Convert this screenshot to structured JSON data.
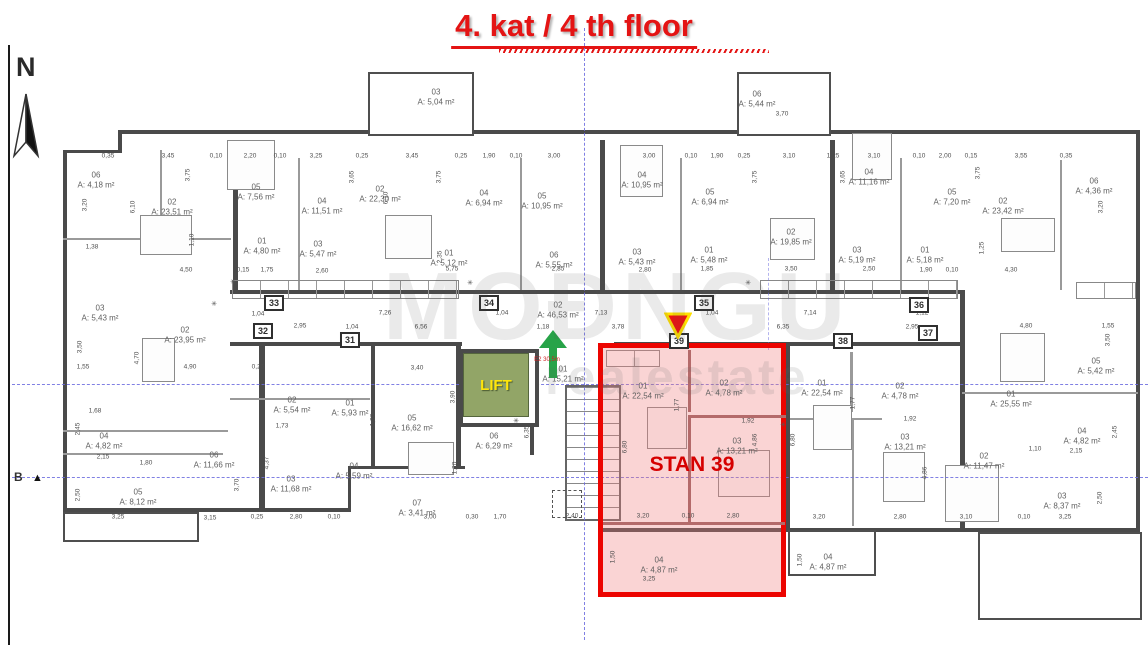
{
  "title": "4. kat / 4 th floor",
  "north": {
    "label": "N"
  },
  "section_marker": {
    "label": "B"
  },
  "watermark": {
    "line1": "MOĐNGU",
    "line2": "realestate"
  },
  "lift": {
    "label": "LIFT"
  },
  "stairwell_note": {
    "text": "E2 30,5m"
  },
  "highlight": {
    "label": "STAN 39",
    "apartment_no": "39"
  },
  "colors": {
    "title_red": "#e41414",
    "highlight_border": "#ec0400",
    "highlight_fill": "rgba(240,125,125,0.33)",
    "lift_green": "#92a567",
    "lift_text": "#ffe60a",
    "axis_blue": "#6b6bdf",
    "arrow_green": "#27a348",
    "marker_yellow": "#ffe000",
    "wall_gray": "#4a4a4a",
    "label_gray": "#5f5f5f"
  },
  "plan": {
    "rooms": [
      {
        "no": "06",
        "area": "A: 4,18 m²",
        "x": 96,
        "y": 180
      },
      {
        "no": "02",
        "area": "A: 23,51 m²",
        "x": 172,
        "y": 207
      },
      {
        "no": "05",
        "area": "A: 7,56 m²",
        "x": 256,
        "y": 192
      },
      {
        "no": "04",
        "area": "A: 11,51 m²",
        "x": 322,
        "y": 206
      },
      {
        "no": "01",
        "area": "A: 4,80 m²",
        "x": 262,
        "y": 246
      },
      {
        "no": "03",
        "area": "A: 5,47 m²",
        "x": 318,
        "y": 249
      },
      {
        "no": "03",
        "area": "A: 5,04 m²",
        "x": 436,
        "y": 97
      },
      {
        "no": "02",
        "area": "A: 22,30 m²",
        "x": 380,
        "y": 194
      },
      {
        "no": "04",
        "area": "A: 6,94 m²",
        "x": 484,
        "y": 198
      },
      {
        "no": "05",
        "area": "A: 10,95 m²",
        "x": 542,
        "y": 201
      },
      {
        "no": "01",
        "area": "A: 5,12 m²",
        "x": 449,
        "y": 258
      },
      {
        "no": "06",
        "area": "A: 5,55 m²",
        "x": 554,
        "y": 260
      },
      {
        "no": "06",
        "area": "A: 5,44 m²",
        "x": 757,
        "y": 99
      },
      {
        "no": "04",
        "area": "A: 10,95 m²",
        "x": 642,
        "y": 180
      },
      {
        "no": "05",
        "area": "A: 6,94 m²",
        "x": 710,
        "y": 197
      },
      {
        "no": "02",
        "area": "A: 19,85 m²",
        "x": 791,
        "y": 237
      },
      {
        "no": "01",
        "area": "A: 5,48 m²",
        "x": 709,
        "y": 255
      },
      {
        "no": "03",
        "area": "A: 5,43 m²",
        "x": 637,
        "y": 257
      },
      {
        "no": "03",
        "area": "A: 5,19 m²",
        "x": 857,
        "y": 255
      },
      {
        "no": "04",
        "area": "A: 11,16 m²",
        "x": 869,
        "y": 177
      },
      {
        "no": "05",
        "area": "A: 7,20 m²",
        "x": 952,
        "y": 197
      },
      {
        "no": "02",
        "area": "A: 23,42 m²",
        "x": 1003,
        "y": 206
      },
      {
        "no": "06",
        "area": "A: 4,36 m²",
        "x": 1094,
        "y": 186
      },
      {
        "no": "01",
        "area": "A: 5,18 m²",
        "x": 925,
        "y": 255
      },
      {
        "no": "02",
        "area": "A: 46,53 m²",
        "x": 558,
        "y": 310
      },
      {
        "no": "01",
        "area": "A: 15,21 m²",
        "x": 563,
        "y": 374
      },
      {
        "no": "06",
        "area": "A: 6,29 m²",
        "x": 494,
        "y": 441
      },
      {
        "no": "05",
        "area": "A: 16,62 m²",
        "x": 412,
        "y": 423
      },
      {
        "no": "01",
        "area": "A: 5,93 m²",
        "x": 350,
        "y": 408
      },
      {
        "no": "07",
        "area": "A: 3,41 m²",
        "x": 417,
        "y": 508
      },
      {
        "no": "02",
        "area": "A: 23,95 m²",
        "x": 185,
        "y": 335
      },
      {
        "no": "03",
        "area": "A: 5,43 m²",
        "x": 100,
        "y": 313
      },
      {
        "no": "02",
        "area": "A: 5,54 m²",
        "x": 292,
        "y": 405
      },
      {
        "no": "04",
        "area": "A: 4,82 m²",
        "x": 104,
        "y": 441
      },
      {
        "no": "06",
        "area": "A: 11,66 m²",
        "x": 214,
        "y": 460
      },
      {
        "no": "05",
        "area": "A: 8,12 m²",
        "x": 138,
        "y": 497
      },
      {
        "no": "03",
        "area": "A: 11,68 m²",
        "x": 291,
        "y": 484
      },
      {
        "no": "04",
        "area": "A: 5,59 m²",
        "x": 354,
        "y": 471
      },
      {
        "no": "01",
        "area": "A: 22,54 m²",
        "x": 643,
        "y": 391
      },
      {
        "no": "02",
        "area": "A: 4,78 m²",
        "x": 724,
        "y": 388
      },
      {
        "no": "03",
        "area": "A: 13,21 m²",
        "x": 737,
        "y": 446
      },
      {
        "no": "04",
        "area": "A: 4,87 m²",
        "x": 659,
        "y": 565
      },
      {
        "no": "01",
        "area": "A: 22,54 m²",
        "x": 822,
        "y": 388
      },
      {
        "no": "02",
        "area": "A: 4,78 m²",
        "x": 900,
        "y": 391
      },
      {
        "no": "03",
        "area": "A: 13,21 m²",
        "x": 905,
        "y": 442
      },
      {
        "no": "04",
        "area": "A: 4,87 m²",
        "x": 828,
        "y": 562
      },
      {
        "no": "01",
        "area": "A: 25,55 m²",
        "x": 1011,
        "y": 399
      },
      {
        "no": "02",
        "area": "A: 11,47 m²",
        "x": 984,
        "y": 461
      },
      {
        "no": "03",
        "area": "A: 8,37 m²",
        "x": 1062,
        "y": 501
      },
      {
        "no": "04",
        "area": "A: 4,82 m²",
        "x": 1082,
        "y": 436
      },
      {
        "no": "05",
        "area": "A: 5,42 m²",
        "x": 1096,
        "y": 366
      }
    ],
    "dims_h": [
      {
        "t": "0,35",
        "x": 108,
        "y": 156
      },
      {
        "t": "3,45",
        "x": 168,
        "y": 156
      },
      {
        "t": "0,10",
        "x": 216,
        "y": 156
      },
      {
        "t": "2,20",
        "x": 250,
        "y": 156
      },
      {
        "t": "0,10",
        "x": 280,
        "y": 156
      },
      {
        "t": "3,25",
        "x": 316,
        "y": 156
      },
      {
        "t": "0,25",
        "x": 362,
        "y": 156
      },
      {
        "t": "3,45",
        "x": 412,
        "y": 156
      },
      {
        "t": "0,25",
        "x": 461,
        "y": 156
      },
      {
        "t": "1,90",
        "x": 489,
        "y": 156
      },
      {
        "t": "0,10",
        "x": 516,
        "y": 156
      },
      {
        "t": "3,00",
        "x": 554,
        "y": 156
      },
      {
        "t": "3,00",
        "x": 649,
        "y": 156
      },
      {
        "t": "0,10",
        "x": 691,
        "y": 156
      },
      {
        "t": "1,90",
        "x": 717,
        "y": 156
      },
      {
        "t": "0,25",
        "x": 744,
        "y": 156
      },
      {
        "t": "3,10",
        "x": 789,
        "y": 156
      },
      {
        "t": "1,25",
        "x": 833,
        "y": 156
      },
      {
        "t": "3,10",
        "x": 874,
        "y": 156
      },
      {
        "t": "0,10",
        "x": 919,
        "y": 156
      },
      {
        "t": "2,00",
        "x": 945,
        "y": 156
      },
      {
        "t": "0,15",
        "x": 971,
        "y": 156
      },
      {
        "t": "3,55",
        "x": 1021,
        "y": 156
      },
      {
        "t": "0,35",
        "x": 1066,
        "y": 156
      },
      {
        "t": "3,70",
        "x": 782,
        "y": 114
      },
      {
        "t": "1,38",
        "x": 92,
        "y": 247
      },
      {
        "t": "4,50",
        "x": 186,
        "y": 270
      },
      {
        "t": "0,15",
        "x": 243,
        "y": 270
      },
      {
        "t": "1,75",
        "x": 267,
        "y": 270
      },
      {
        "t": "2,60",
        "x": 322,
        "y": 271
      },
      {
        "t": "5,75",
        "x": 452,
        "y": 269
      },
      {
        "t": "2,85",
        "x": 558,
        "y": 269
      },
      {
        "t": "2,80",
        "x": 645,
        "y": 270
      },
      {
        "t": "1,85",
        "x": 707,
        "y": 269
      },
      {
        "t": "3,50",
        "x": 791,
        "y": 269
      },
      {
        "t": "2,50",
        "x": 869,
        "y": 269
      },
      {
        "t": "1,90",
        "x": 926,
        "y": 270
      },
      {
        "t": "0,10",
        "x": 952,
        "y": 270
      },
      {
        "t": "4,30",
        "x": 1011,
        "y": 270
      },
      {
        "t": "1,04",
        "x": 258,
        "y": 314
      },
      {
        "t": "7,26",
        "x": 385,
        "y": 313
      },
      {
        "t": "1,04",
        "x": 502,
        "y": 313
      },
      {
        "t": "7,13",
        "x": 601,
        "y": 313
      },
      {
        "t": "1,04",
        "x": 712,
        "y": 313
      },
      {
        "t": "7,14",
        "x": 810,
        "y": 313
      },
      {
        "t": "1,12",
        "x": 922,
        "y": 313
      },
      {
        "t": "2,95",
        "x": 300,
        "y": 326
      },
      {
        "t": "1,04",
        "x": 352,
        "y": 327
      },
      {
        "t": "6,56",
        "x": 421,
        "y": 327
      },
      {
        "t": "1,18",
        "x": 543,
        "y": 327
      },
      {
        "t": "3,78",
        "x": 618,
        "y": 327
      },
      {
        "t": "6,35",
        "x": 783,
        "y": 327
      },
      {
        "t": "2,95",
        "x": 912,
        "y": 327
      },
      {
        "t": "4,80",
        "x": 1026,
        "y": 326
      },
      {
        "t": "1,55",
        "x": 1108,
        "y": 326
      },
      {
        "t": "1,55",
        "x": 83,
        "y": 367
      },
      {
        "t": "4,90",
        "x": 190,
        "y": 367
      },
      {
        "t": "0,25",
        "x": 258,
        "y": 367
      },
      {
        "t": "3,40",
        "x": 417,
        "y": 368
      },
      {
        "t": "1,68",
        "x": 95,
        "y": 411
      },
      {
        "t": "2,15",
        "x": 103,
        "y": 457
      },
      {
        "t": "1,80",
        "x": 146,
        "y": 463
      },
      {
        "t": "1,73",
        "x": 282,
        "y": 426
      },
      {
        "t": "1,92",
        "x": 748,
        "y": 421
      },
      {
        "t": "1,92",
        "x": 910,
        "y": 419
      },
      {
        "t": "1,10",
        "x": 1035,
        "y": 449
      },
      {
        "t": "2,15",
        "x": 1076,
        "y": 451
      },
      {
        "t": "3,25",
        "x": 118,
        "y": 517
      },
      {
        "t": "3,15",
        "x": 210,
        "y": 518
      },
      {
        "t": "0,25",
        "x": 257,
        "y": 517
      },
      {
        "t": "2,80",
        "x": 296,
        "y": 517
      },
      {
        "t": "0,10",
        "x": 334,
        "y": 517
      },
      {
        "t": "3,00",
        "x": 430,
        "y": 517
      },
      {
        "t": "0,30",
        "x": 472,
        "y": 517
      },
      {
        "t": "1,70",
        "x": 500,
        "y": 517
      },
      {
        "t": "2,40",
        "x": 572,
        "y": 516
      },
      {
        "t": "3,20",
        "x": 643,
        "y": 516
      },
      {
        "t": "0,10",
        "x": 688,
        "y": 516
      },
      {
        "t": "2,80",
        "x": 733,
        "y": 516
      },
      {
        "t": "3,20",
        "x": 819,
        "y": 517
      },
      {
        "t": "2,80",
        "x": 900,
        "y": 517
      },
      {
        "t": "3,10",
        "x": 966,
        "y": 517
      },
      {
        "t": "0,10",
        "x": 1024,
        "y": 517
      },
      {
        "t": "3,25",
        "x": 1065,
        "y": 517
      },
      {
        "t": "3,25",
        "x": 649,
        "y": 579
      }
    ],
    "dims_v": [
      {
        "t": "3,75",
        "x": 188,
        "y": 175
      },
      {
        "t": "6,10",
        "x": 133,
        "y": 207
      },
      {
        "t": "3,20",
        "x": 85,
        "y": 205
      },
      {
        "t": "1,10",
        "x": 192,
        "y": 240
      },
      {
        "t": "3,65",
        "x": 352,
        "y": 177
      },
      {
        "t": "3,75",
        "x": 439,
        "y": 177
      },
      {
        "t": "6,10",
        "x": 386,
        "y": 198
      },
      {
        "t": "2,35",
        "x": 440,
        "y": 257
      },
      {
        "t": "3,75",
        "x": 755,
        "y": 177
      },
      {
        "t": "3,65",
        "x": 843,
        "y": 177
      },
      {
        "t": "3,75",
        "x": 978,
        "y": 173
      },
      {
        "t": "3,20",
        "x": 1101,
        "y": 207
      },
      {
        "t": "1,25",
        "x": 982,
        "y": 248
      },
      {
        "t": "3,50",
        "x": 80,
        "y": 347
      },
      {
        "t": "4,70",
        "x": 137,
        "y": 358
      },
      {
        "t": "2,45",
        "x": 78,
        "y": 429
      },
      {
        "t": "2,50",
        "x": 78,
        "y": 495
      },
      {
        "t": "4,37",
        "x": 267,
        "y": 463
      },
      {
        "t": "3,70",
        "x": 237,
        "y": 485
      },
      {
        "t": "3,90",
        "x": 453,
        "y": 397
      },
      {
        "t": "1,20",
        "x": 373,
        "y": 420
      },
      {
        "t": "1,20",
        "x": 455,
        "y": 468
      },
      {
        "t": "6,35",
        "x": 527,
        "y": 432
      },
      {
        "t": "1,77",
        "x": 677,
        "y": 405
      },
      {
        "t": "6,80",
        "x": 625,
        "y": 447
      },
      {
        "t": "4,86",
        "x": 755,
        "y": 440
      },
      {
        "t": "1,50",
        "x": 613,
        "y": 557
      },
      {
        "t": "1,77",
        "x": 853,
        "y": 403
      },
      {
        "t": "6,80",
        "x": 793,
        "y": 440
      },
      {
        "t": "4,86",
        "x": 925,
        "y": 473
      },
      {
        "t": "1,50",
        "x": 800,
        "y": 560
      },
      {
        "t": "2,45",
        "x": 1115,
        "y": 432
      },
      {
        "t": "2,50",
        "x": 1100,
        "y": 498
      },
      {
        "t": "3,50",
        "x": 1108,
        "y": 340
      }
    ],
    "apt_boxes": [
      {
        "no": "31",
        "x": 350,
        "y": 340
      },
      {
        "no": "32",
        "x": 263,
        "y": 331
      },
      {
        "no": "33",
        "x": 274,
        "y": 303
      },
      {
        "no": "34",
        "x": 489,
        "y": 303
      },
      {
        "no": "35",
        "x": 704,
        "y": 303
      },
      {
        "no": "36",
        "x": 919,
        "y": 305
      },
      {
        "no": "37",
        "x": 928,
        "y": 333
      },
      {
        "no": "38",
        "x": 843,
        "y": 341
      },
      {
        "no": "39",
        "x": 679,
        "y": 341
      }
    ],
    "symbols": [
      {
        "t": "✳",
        "x": 233,
        "y": 282
      },
      {
        "t": "✳",
        "x": 214,
        "y": 304
      },
      {
        "t": "✳",
        "x": 470,
        "y": 283
      },
      {
        "t": "✳",
        "x": 748,
        "y": 283
      },
      {
        "t": "✳",
        "x": 516,
        "y": 421
      },
      {
        "t": "✳",
        "x": 783,
        "y": 425
      }
    ]
  }
}
